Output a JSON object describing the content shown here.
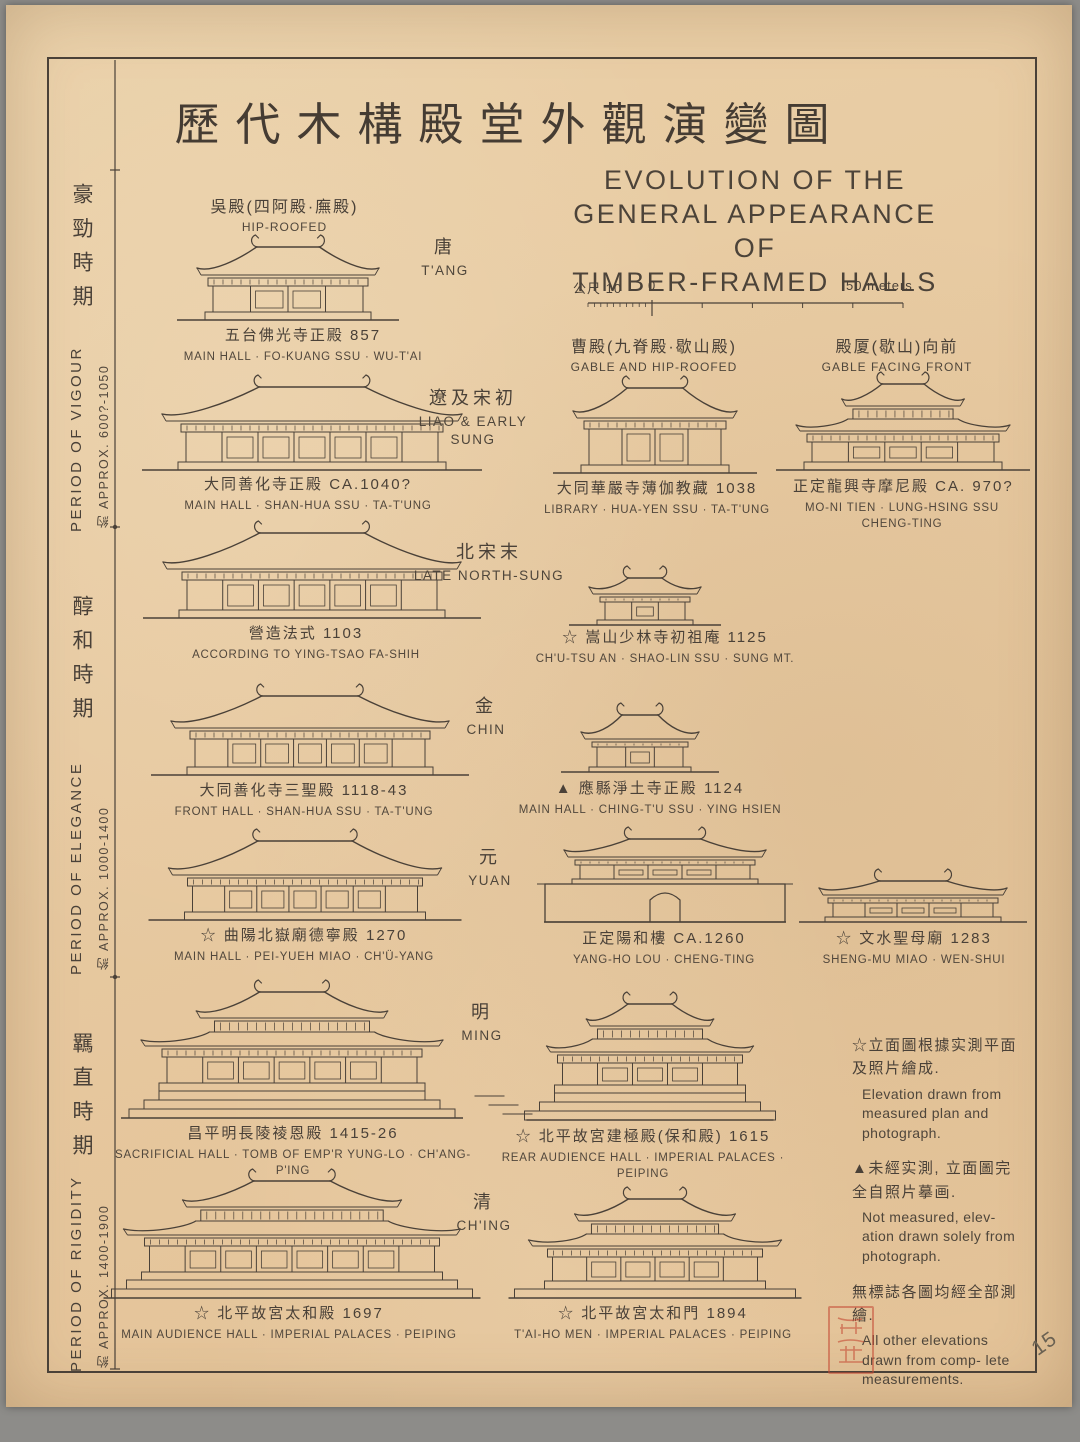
{
  "title": {
    "cn": "歷代木構殿堂外觀演變圖"
  },
  "subtitle": {
    "line1": "EVOLUTION OF THE",
    "line2": "GENERAL APPEARANCE OF",
    "line3": "TIMBER-FRAMED HALLS"
  },
  "scale_bar": {
    "left_label": "公尺 10",
    "zero_label": "0",
    "right_label": "50 meters"
  },
  "roof_types": [
    {
      "cn": "吳殿(四阿殿·廡殿)",
      "en": "HIP-ROOFED"
    },
    {
      "cn": "曹殿(九脊殿·歇山殿)",
      "en": "GABLE AND HIP-ROOFED"
    },
    {
      "cn": "殿厦(歇山)向前",
      "en": "GABLE FACING FRONT"
    }
  ],
  "periods": [
    {
      "cn": "豪勁時期",
      "en": "PERIOD OF VIGOUR",
      "approx": "約 APPROX.  600?-1050"
    },
    {
      "cn": "醇和時期",
      "en": "PERIOD OF ELEGANCE",
      "approx": "約 APPROX.  1000-1400"
    },
    {
      "cn": "羈直時期",
      "en": "PERIOD OF RIGIDITY",
      "approx": "約 APPROX.  1400-1900"
    }
  ],
  "eras": [
    {
      "cn": "唐",
      "en": "T'ANG"
    },
    {
      "cn": "遼及宋初",
      "en": "LIAO & EARLY SUNG"
    },
    {
      "cn": "北宋末",
      "en": "LATE NORTH-SUNG"
    },
    {
      "cn": "金",
      "en": "CHIN"
    },
    {
      "cn": "元",
      "en": "YUAN"
    },
    {
      "cn": "明",
      "en": "MING"
    },
    {
      "cn": "清",
      "en": "CH'ING"
    }
  ],
  "buildings": [
    {
      "cn": "五台佛光寺正殿  857",
      "en": "MAIN HALL · FO-KUANG SSU · WU-T'AI"
    },
    {
      "cn": "大同善化寺正殿  CA.1040?",
      "en": "MAIN HALL · SHAN-HUA SSU · TA-T'UNG"
    },
    {
      "cn": "大同華嚴寺薄伽教藏 1038",
      "en": "LIBRARY · HUA-YEN SSU · TA-T'UNG"
    },
    {
      "cn": "正定龍興寺摩尼殿  CA. 970?",
      "en": "MO-NI TIEN · LUNG-HSING SSU CHENG-TING"
    },
    {
      "cn": "營造法式 1103",
      "en": "ACCORDING TO YING-TSAO FA-SHIH"
    },
    {
      "cn": "☆ 嵩山少林寺初祖庵  1125",
      "en": "CH'U-TSU AN · SHAO-LIN SSU · SUNG MT."
    },
    {
      "cn": "大同善化寺三聖殿  1118-43",
      "en": "FRONT HALL · SHAN-HUA SSU · TA-T'UNG"
    },
    {
      "cn": "▲ 應縣淨土寺正殿 1124",
      "en": "MAIN HALL · CHING-T'U SSU · YING HSIEN"
    },
    {
      "cn": "☆ 曲陽北嶽廟德寧殿  1270",
      "en": "MAIN HALL · PEI-YUEH MIAO · CH'Ü-YANG"
    },
    {
      "cn": "正定陽和樓  CA.1260",
      "en": "YANG-HO LOU · CHENG-TING"
    },
    {
      "cn": "☆ 文水聖母廟 1283",
      "en": "SHENG-MU MIAO · WEN-SHUI"
    },
    {
      "cn": "昌平明長陵祾恩殿  1415-26",
      "en": "SACRIFICIAL HALL · TOMB OF EMP'R YUNG-LO · CH'ANG-P'ING"
    },
    {
      "cn": "☆ 北平故宮建極殿(保和殿) 1615",
      "en": "REAR AUDIENCE HALL · IMPERIAL PALACES · PEIPING"
    },
    {
      "cn": "☆ 北平故宮太和殿  1697",
      "en": "MAIN AUDIENCE HALL · IMPERIAL PALACES · PEIPING"
    },
    {
      "cn": "☆ 北平故宮太和門 1894",
      "en": "T'AI-HO MEN · IMPERIAL PALACES · PEIPING"
    }
  ],
  "legend": [
    {
      "symbol": "☆",
      "cn": "立面圖根據实測平面及照片繪成.",
      "en": "Elevation drawn from measured plan and photograph."
    },
    {
      "symbol": "▲",
      "cn": "未經实測, 立面圖完全自照片摹画.",
      "en": "Not measured, elev- ation drawn solely from photograph."
    },
    {
      "symbol": "",
      "cn": "無標誌各圖均經全部測繪.",
      "en": "All other elevations drawn from comp- lete measurements."
    }
  ],
  "annotations": {
    "page_number": "15"
  },
  "colors": {
    "ink": "#4a4138",
    "paper": "#e7c9a0",
    "seal_red": "#c54a34",
    "backdrop": "#8d8c89"
  }
}
